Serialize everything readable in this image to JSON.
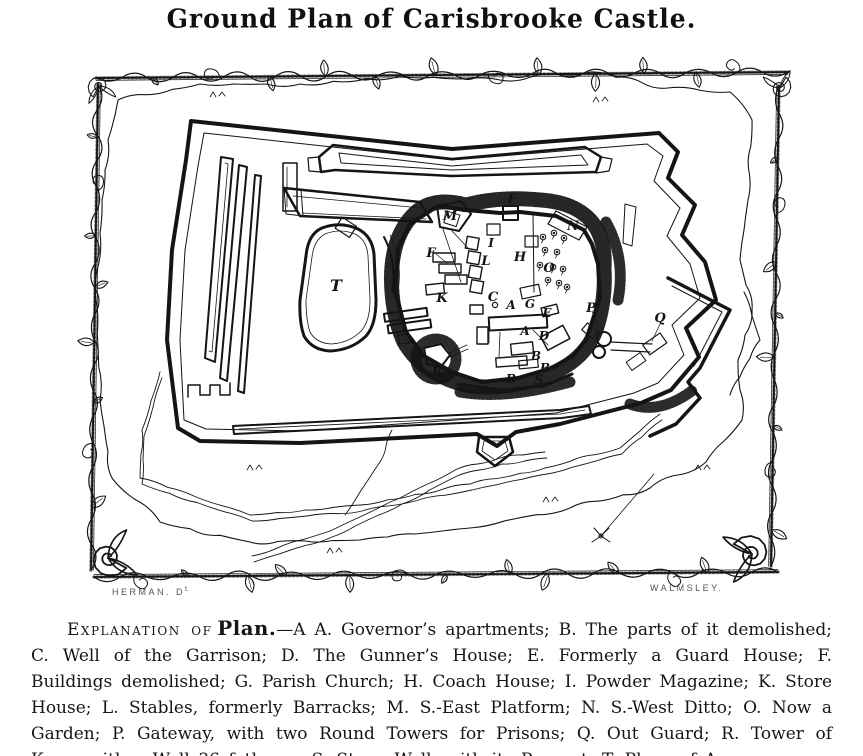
{
  "page": {
    "title": "Ground Plan of Carisbrooke Castle."
  },
  "colors": {
    "paper": "#ffffff",
    "ink": "#151515"
  },
  "plate": {
    "credit_left": "HERMAN. D",
    "credit_left_sup": "t.",
    "credit_right": "WALMSLEY.",
    "labels": [
      {
        "letter": "T",
        "x": 336,
        "y": 291,
        "size": 16
      },
      {
        "letter": "M",
        "x": 450,
        "y": 220,
        "size": 13
      },
      {
        "letter": "F",
        "x": 512,
        "y": 203,
        "size": 13
      },
      {
        "letter": "N",
        "x": 573,
        "y": 230,
        "size": 13
      },
      {
        "letter": "I",
        "x": 491,
        "y": 247,
        "size": 12
      },
      {
        "letter": "F",
        "x": 431,
        "y": 257,
        "size": 13
      },
      {
        "letter": "L",
        "x": 486,
        "y": 265,
        "size": 13
      },
      {
        "letter": "H",
        "x": 520,
        "y": 261,
        "size": 13
      },
      {
        "letter": "O",
        "x": 549,
        "y": 272,
        "size": 13
      },
      {
        "letter": "K",
        "x": 442,
        "y": 302,
        "size": 13
      },
      {
        "letter": "C",
        "x": 493,
        "y": 301,
        "size": 13
      },
      {
        "letter": "A",
        "x": 511,
        "y": 309,
        "size": 12
      },
      {
        "letter": "G",
        "x": 530,
        "y": 308,
        "size": 12
      },
      {
        "letter": "E",
        "x": 547,
        "y": 317,
        "size": 12
      },
      {
        "letter": "P",
        "x": 591,
        "y": 312,
        "size": 13
      },
      {
        "letter": "Q",
        "x": 660,
        "y": 322,
        "size": 13
      },
      {
        "letter": "A",
        "x": 525,
        "y": 335,
        "size": 12
      },
      {
        "letter": "D",
        "x": 544,
        "y": 340,
        "size": 12
      },
      {
        "letter": "B",
        "x": 536,
        "y": 360,
        "size": 12
      },
      {
        "letter": "B",
        "x": 545,
        "y": 372,
        "size": 12
      },
      {
        "letter": "B",
        "x": 511,
        "y": 383,
        "size": 12
      },
      {
        "letter": "S",
        "x": 539,
        "y": 384,
        "size": 13
      },
      {
        "letter": "R",
        "x": 437,
        "y": 376,
        "size": 13
      }
    ]
  },
  "explanation": {
    "lead": "Explanation of",
    "plan_word": "Plan.",
    "body": "—A A. Governor’s apartments; B. The parts of it demolished; C. Well of the Garrison; D. The Gunner’s House; E. Formerly a Guard House; F. Buildings demolished; G. Parish Church; H. Coach House; I. Powder Magazine; K. Store House; L. Stables, formerly Barracks; M. S.-East Platform; N. S.-West Ditto; O. Now a Garden; P. Gateway, with two Round Towers for Prisons; Q. Out Guard; R. Tower of Keep, with a Well 36 fathoms; S. Stone Wall, with its Parapet; T. Place of Arms."
  }
}
